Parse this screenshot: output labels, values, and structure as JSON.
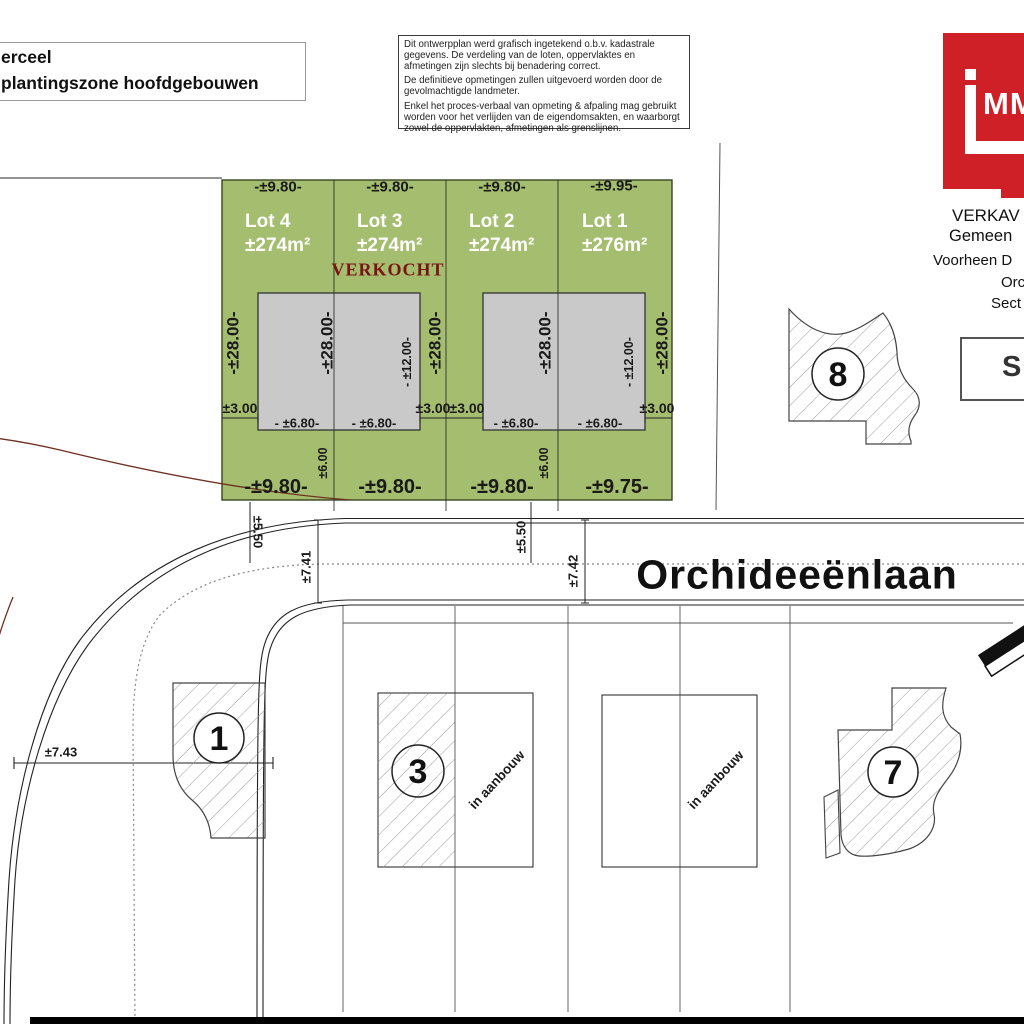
{
  "legend": {
    "line1": "erceel",
    "line2": "plantingszone hoofdgebouwen"
  },
  "disclaimer": {
    "p1": "Dit ontwerpplan werd grafisch ingetekend o.b.v. kadastrale gegevens. De verdeling van de loten, oppervlaktes en afmetingen zijn slechts bij benadering correct.",
    "p2": "De definitieve opmetingen zullen uitgevoerd worden door de gevolmachtigde landmeter.",
    "p3": "Enkel het proces-verbaal van opmeting & afpaling mag gebruikt worden voor het verlijden van de eigendomsakten, en waarborgt zowel de oppervlakten, afmetingen als grenslijnen."
  },
  "logo": {
    "mm": "MM"
  },
  "header_right": {
    "l1": "VERKAV",
    "l2": "Gemeen",
    "l3": "Voorheen D",
    "l4": "Orc",
    "l5": "Sect",
    "scale": "SC"
  },
  "colors": {
    "green_zone": "#a4bd6e",
    "building_zone": "#c9c9c9",
    "logo_red": "#cf2027",
    "verkocht_red": "#7a1414",
    "boundary_red": "#6e2f20"
  },
  "lots": [
    {
      "name": "Lot 4",
      "area": "±274m²",
      "front": "-±9.80-",
      "rear": "-±9.80-"
    },
    {
      "name": "Lot 3",
      "area": "±274m²",
      "front": "-±9.80-",
      "rear": "-±9.80-",
      "status": "VERKOCHT"
    },
    {
      "name": "Lot 2",
      "area": "±274m²",
      "front": "-±9.80-",
      "rear": "-±9.80-"
    },
    {
      "name": "Lot 1",
      "area": "±276m²",
      "front": "-±9.95-",
      "rear": "-±9.75-"
    }
  ],
  "dims": {
    "depth": "-±28.00-",
    "block_depth": "- ±12.00-",
    "side_setback": "±3.00",
    "block_half": "- ±6.80-",
    "rear_setback": "±6.00"
  },
  "road": {
    "name": "Orchideeënlaan",
    "d550": "±5.50",
    "d741": "±7.41",
    "d742": "±7.42",
    "d743": "±7.43"
  },
  "parcels": {
    "n1": "1",
    "n3": "3",
    "n7": "7",
    "n8": "8",
    "note": "in aanbouw"
  }
}
